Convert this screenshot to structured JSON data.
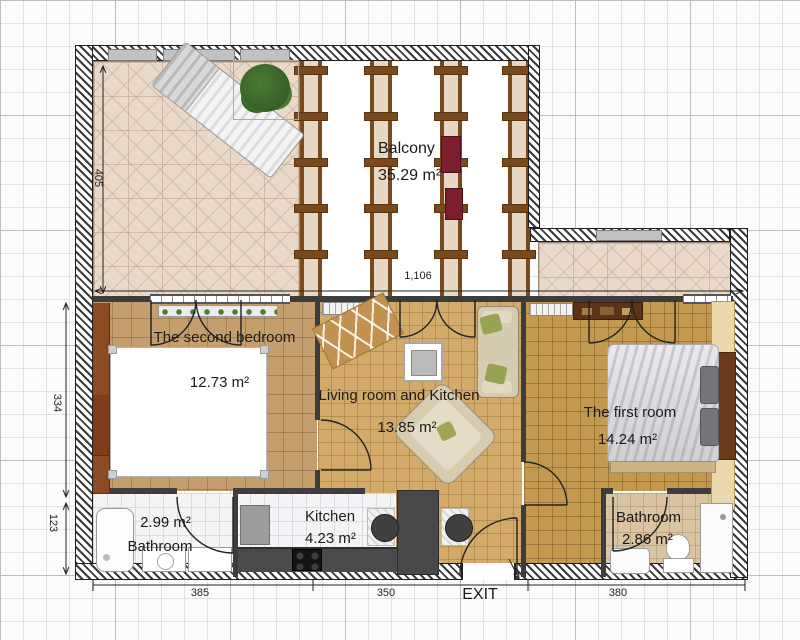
{
  "rooms": {
    "balcony": {
      "name": "Balcony",
      "area": "35.29 m²"
    },
    "second_bedroom": {
      "name": "The second bedroom",
      "area": "12.73 m²"
    },
    "living": {
      "name": "Living room and Kitchen",
      "area": "13.85 m²"
    },
    "first_room": {
      "name": "The first room",
      "area": "14.24 m²"
    },
    "kitchen": {
      "name": "Kitchen",
      "area": "4.23 m²"
    },
    "bathroom_left": {
      "name": "Bathroom",
      "area": "2.99 m²"
    },
    "bathroom_right": {
      "name": "Bathroom",
      "area": "2.86 m²"
    }
  },
  "dimensions": {
    "terrace_height": "405",
    "rooms_height": "334",
    "bottom_height": "123",
    "width_left": "385",
    "width_center": "350",
    "width_right": "380",
    "total_width": "1,106"
  },
  "labels": {
    "exit": "EXIT"
  },
  "palette": {
    "wall_dark": "#3a3a3a",
    "terrace_tile": "#ead9c9",
    "bedroom_floor": "#c59e6e",
    "living_floor": "#d3aa6a",
    "first_room_floor": "#c3984f",
    "bath_right_floor": "#d9c4a4",
    "wood_beam": "#7a4a1e",
    "wardrobe": "#8a4a22",
    "counter_dark": "#4a4a4a",
    "accent_red": "#7c1f2d",
    "sofa_beige": "#d5cbb0",
    "pillow_green": "#97a351"
  }
}
